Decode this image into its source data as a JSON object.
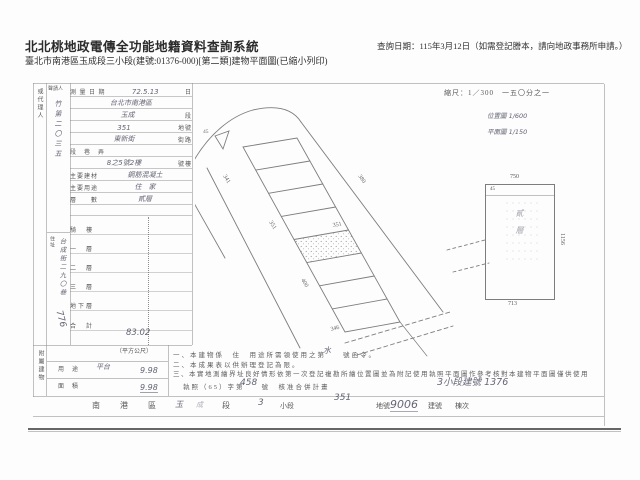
{
  "colors": {
    "ink": "#575757",
    "handwriting": "#4a4a5e",
    "rule": "#8f8f8f"
  },
  "header": {
    "system_title": "北北桃地政電傳全功能地籍資料查詢系統",
    "query_date": "查詢日期：115年3月12日（如需登記謄本，請向地政事務所申請。）",
    "document_line": "臺北市南港區玉成段三小段(建號:01376-000)[第二類]建物平面圖(已縮小列印)"
  },
  "scan": {
    "applicant": {
      "agent_label": "或代理人",
      "applicant_label": "聲請人",
      "name_hand": "竹第二〇三五",
      "addr_label": "住址",
      "addr_hand": "台成街二九〇巷",
      "num_hand": "776"
    },
    "form_rows": [
      {
        "p": "測 量 日 期",
        "h": "72.5.13",
        "s": "日"
      },
      {
        "p": "",
        "h": "台北市南港區",
        "s": ""
      },
      {
        "p": "",
        "h": "玉成",
        "s": "段"
      },
      {
        "p": "",
        "h": "351",
        "s": "地號"
      },
      {
        "p": "",
        "h": "東新街",
        "s": "街路"
      },
      {
        "p": "段　巷　弄",
        "h": "",
        "s": ""
      },
      {
        "p": "",
        "h": "8之5號2樓",
        "s": "號樓"
      },
      {
        "p": "主要建材",
        "h": "鋼筋混凝土",
        "s": ""
      },
      {
        "p": "主要用途",
        "h": "住　家",
        "s": ""
      },
      {
        "p": "層　　數",
        "h": "貳層",
        "s": ""
      }
    ],
    "area_rows": [
      {
        "p": "騎　樓",
        "h": ""
      },
      {
        "p": "一　層",
        "h": ""
      },
      {
        "p": "二　層",
        "h": ""
      },
      {
        "p": "三　層",
        "h": ""
      },
      {
        "p": "地下層",
        "h": ""
      },
      {
        "p": "合　計",
        "h": "83.02"
      }
    ],
    "annex": {
      "label": "附屬建物",
      "unit": "（平方公尺）",
      "r1p": "用　途",
      "r1h": "平台",
      "r2p": "面　積",
      "r2h": "9.98",
      "r3h": "9.98"
    },
    "diagram": {
      "corner": "45",
      "road_left": "341",
      "road_mid": "351",
      "road_right": "380",
      "road_lower": "400",
      "road_bottom": "346",
      "parcel": "351"
    },
    "plan": {
      "scale": "縮尺：1／300　一五〇分之一",
      "note1": "位置圖 1/600",
      "note2": "平面圖 1/150",
      "dim_top": "750",
      "dim_inner": "45",
      "dim_right": "1156",
      "dim_bottom": "713",
      "interior": "貳層"
    },
    "notes": {
      "n1": "一、本建物係　住　用途所需領使用之第　　號函令。",
      "n1_hand": "水",
      "n2": "二、本成果表以供辦理登記為限。",
      "n3": "三、本實地測繪界址良好情形依第一次登記複勘所繪位置圖並為附記使用執照平面圖作參考核對本建物平面圖僅供使用",
      "n4": "執照（65）字第　　號　核准合併計畫",
      "n4_hand": "458",
      "n4_side": "3小段建號 1376"
    },
    "footer": {
      "f1": "南",
      "f2": "港",
      "f3": "區",
      "f4": "玉",
      "f5": "成",
      "f6": "段",
      "f7": "3",
      "f8": "小段",
      "f9": "351",
      "f10": "地號",
      "f11": "9006",
      "f12": "建號",
      "f13": "棟次"
    }
  }
}
